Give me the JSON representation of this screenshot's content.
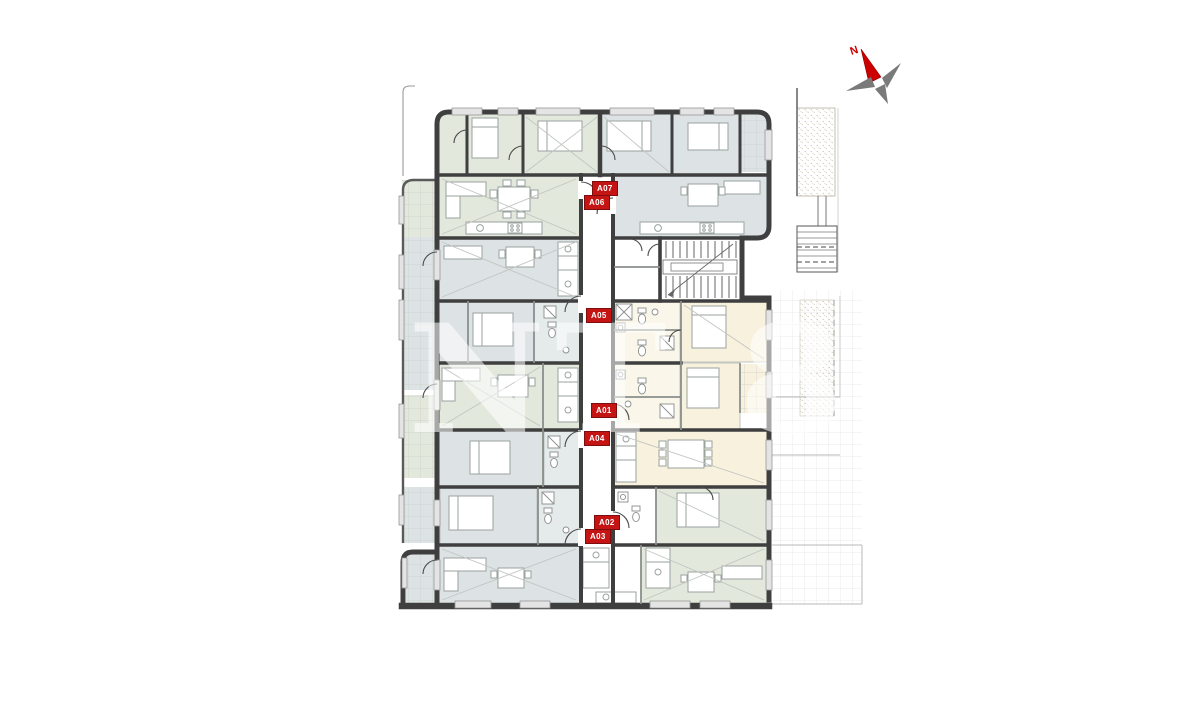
{
  "units": [
    {
      "id": "A07",
      "label": "A07"
    },
    {
      "id": "A06",
      "label": "A06"
    },
    {
      "id": "A05",
      "label": "A05"
    },
    {
      "id": "A01",
      "label": "A01"
    },
    {
      "id": "A04",
      "label": "A04"
    },
    {
      "id": "A02",
      "label": "A02"
    },
    {
      "id": "A03",
      "label": "A03"
    }
  ],
  "compass": {
    "label": "N"
  },
  "watermark": {
    "text": "NT 8"
  },
  "colors": {
    "wall": "#3f3f3f",
    "badge": "#c41414",
    "badge_text": "#ffffff",
    "room_green": "#e3e8dd",
    "room_blue": "#dde3e4",
    "room_cream": "#f8f1de",
    "north_red": "#cc0000",
    "compass_gray": "#7a7a7a",
    "tile_line": "#c9cfc9"
  }
}
